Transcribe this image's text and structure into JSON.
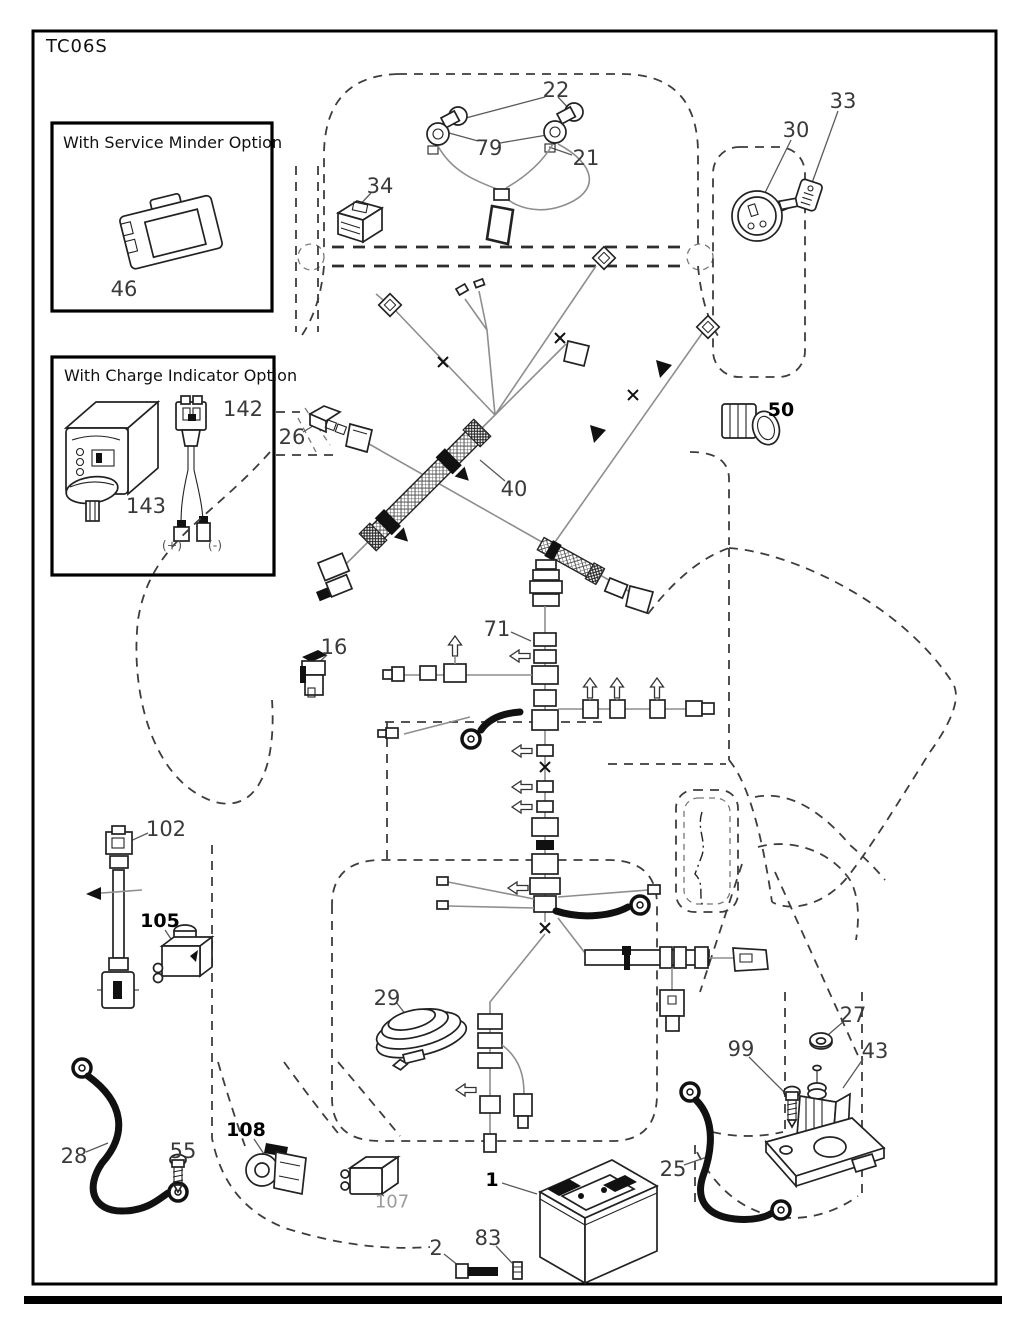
{
  "page": {
    "title": "TC06S"
  },
  "inset_boxes": {
    "service_minder": {
      "title": "With Service Minder Option",
      "part": "46"
    },
    "charge_indicator": {
      "title": "With Charge Indicator Option",
      "parts": [
        "142",
        "143"
      ],
      "polarity_labels": {
        "positive": "(+)",
        "negative": "(-)"
      }
    }
  },
  "colors": {
    "line": "#222222",
    "wire": "#8e8e8e",
    "dash": "#3d3d3d",
    "label": "#3a3a3a",
    "label_bold": "#000000",
    "label_muted": "#9c9c9c",
    "background": "#ffffff"
  },
  "callouts": [
    {
      "text": "22",
      "x": 556,
      "y": 90
    },
    {
      "text": "79",
      "x": 489,
      "y": 148
    },
    {
      "text": "21",
      "x": 586,
      "y": 158
    },
    {
      "text": "34",
      "x": 380,
      "y": 186
    },
    {
      "text": "33",
      "x": 843,
      "y": 101
    },
    {
      "text": "30",
      "x": 796,
      "y": 130
    },
    {
      "text": "46",
      "x": 124,
      "y": 289
    },
    {
      "text": "142",
      "x": 243,
      "y": 409
    },
    {
      "text": "143",
      "x": 146,
      "y": 506
    },
    {
      "text": "26",
      "x": 292,
      "y": 437
    },
    {
      "text": "40",
      "x": 514,
      "y": 489
    },
    {
      "text": "50",
      "x": 781,
      "y": 410,
      "style": "bold"
    },
    {
      "text": "16",
      "x": 334,
      "y": 647
    },
    {
      "text": "71",
      "x": 497,
      "y": 629
    },
    {
      "text": "102",
      "x": 166,
      "y": 829
    },
    {
      "text": "105",
      "x": 160,
      "y": 921,
      "style": "bold"
    },
    {
      "text": "29",
      "x": 387,
      "y": 998
    },
    {
      "text": "27",
      "x": 853,
      "y": 1015
    },
    {
      "text": "99",
      "x": 741,
      "y": 1049
    },
    {
      "text": "43",
      "x": 875,
      "y": 1051
    },
    {
      "text": "28",
      "x": 74,
      "y": 1156
    },
    {
      "text": "55",
      "x": 183,
      "y": 1151
    },
    {
      "text": "108",
      "x": 246,
      "y": 1130,
      "style": "bold"
    },
    {
      "text": "107",
      "x": 392,
      "y": 1202,
      "style": "muted"
    },
    {
      "text": "25",
      "x": 673,
      "y": 1169
    },
    {
      "text": "1",
      "x": 492,
      "y": 1180,
      "style": "bold"
    },
    {
      "text": "2",
      "x": 436,
      "y": 1248
    },
    {
      "text": "83",
      "x": 488,
      "y": 1238
    },
    {
      "text": "(+)",
      "x": 172,
      "y": 545,
      "style": "tiny"
    },
    {
      "text": "(-)",
      "x": 215,
      "y": 545,
      "style": "tiny"
    }
  ]
}
